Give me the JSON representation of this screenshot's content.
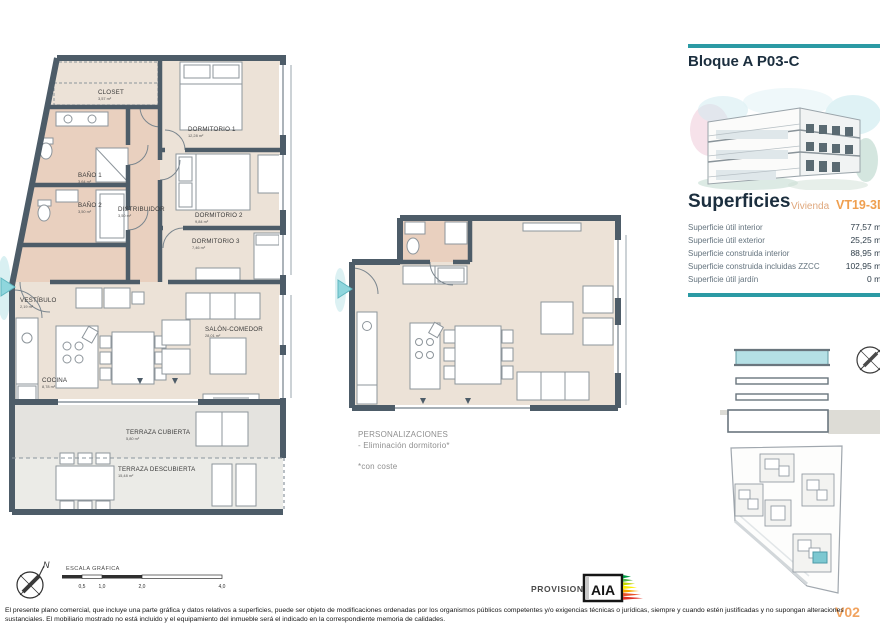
{
  "panel": {
    "block_title": "Bloque A P03-C",
    "superficies_title": "Superficies",
    "vivienda_label": "Vivienda",
    "unit_code": "VT19-3D",
    "rows": [
      {
        "label": "Superficie útil interior",
        "value": "77,57 m²"
      },
      {
        "label": "Superficie útil exterior",
        "value": "25,25 m²"
      },
      {
        "label": "Superficie construida interior",
        "value": "88,95 m²"
      },
      {
        "label": "Superficie construida incluidas ZZCC",
        "value": "102,95 m²"
      },
      {
        "label": "Superficie útil jardín",
        "value": "0 m²"
      }
    ],
    "version": "V02"
  },
  "plan1": {
    "rooms": {
      "closet": {
        "name": "CLOSET",
        "area": "3,57 m²"
      },
      "dormitorio1": {
        "name": "DORMITORIO 1",
        "area": "12,28 m²"
      },
      "bano1": {
        "name": "BAÑO 1",
        "area": "3,64 m²"
      },
      "bano2": {
        "name": "BAÑO 2",
        "area": "3,50 m²"
      },
      "distribuidor": {
        "name": "DISTRIBUIDOR",
        "area": "3,50 m²"
      },
      "dormitorio2": {
        "name": "DORMITORIO 2",
        "area": "9,84 m²"
      },
      "dormitorio3": {
        "name": "DORMITORIO 3",
        "area": "7,46 m²"
      },
      "vestibulo": {
        "name": "VESTÍBULO",
        "area": "2,19 m²"
      },
      "salon": {
        "name": "SALÓN-COMEDOR",
        "area": "28,01 m²"
      },
      "cocina": {
        "name": "COCINA",
        "area": "8,78 m²"
      },
      "terraza_cubierta": {
        "name": "TERRAZA CUBIERTA",
        "area": "5,80 m²"
      },
      "terraza_descubierta": {
        "name": "TERRAZA DESCUBIERTA",
        "area": "15,48 m²"
      }
    }
  },
  "personalizaciones": {
    "title": "PERSONALIZACIONES",
    "item": "- Eliminación dormitorio*",
    "note": "*con coste"
  },
  "scale_bar": {
    "label": "ESCALA GRÁFICA",
    "ticks": [
      "0,5",
      "1,0",
      "2,0",
      "4,0"
    ]
  },
  "compass": {
    "north": "N"
  },
  "provisional": {
    "label": "PROVISIONAL",
    "logo_text": "AIA"
  },
  "disclaimer": "El presente plano comercial, que incluye una parte gráfica y datos relativos a superficies, puede ser objeto de modificaciones ordenadas por los organismos públicos competentes y/o exigencias técnicas o jurídicas, siempre y cuando estén justificadas y no supongan alteraciones sustanciales. El mobiliario mostrado no está incluido y el equipamiento del inmueble será el indicado en la correspondiente memoria de calidades.",
  "colors": {
    "accent_teal": "#2b9aa4",
    "wall": "#4d5c68",
    "room_beige": "#ece2d7",
    "bath_pink": "#e9d0bf",
    "terrace_gray": "#e4e3df",
    "highlight_teal": "#7cc8d1",
    "orange": "#ef9f4f"
  }
}
